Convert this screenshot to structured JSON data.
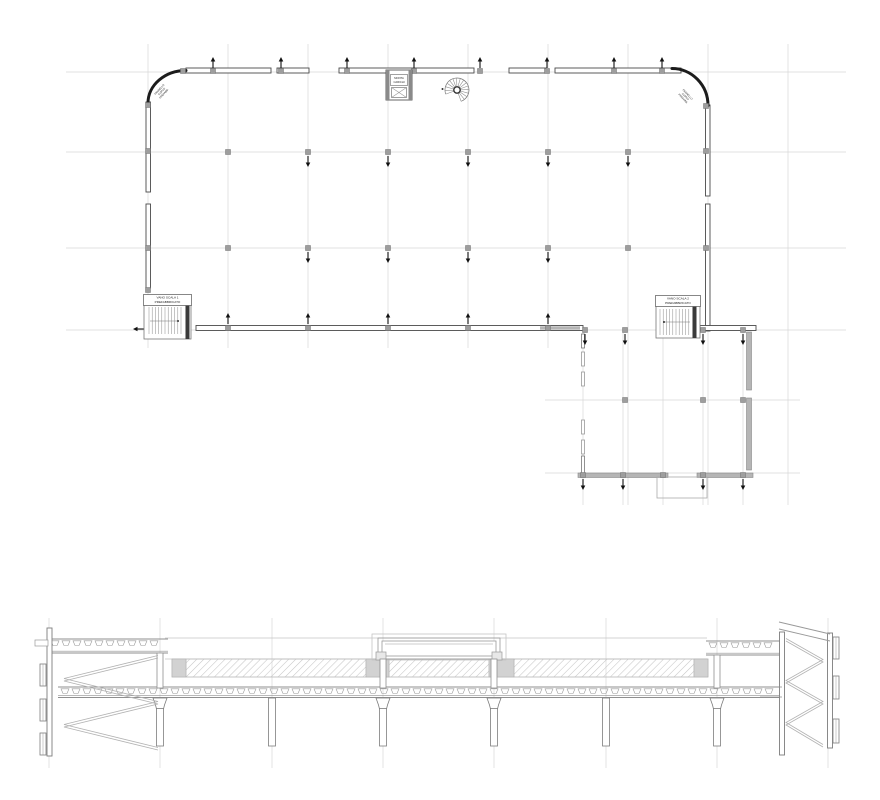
{
  "colors": {
    "grid": "#d7d7d7",
    "wall": "#4a4a4a",
    "dark": "#1c1c1c",
    "arrow": "#111111",
    "column_fill": "#9e9e9e",
    "column_stroke": "#707070",
    "gray_band": "#b5b5b5",
    "hatch_line": "#c6c6c6",
    "section_stroke": "#8f8f8f",
    "section_light": "#c4c4c4",
    "zigzag": "#b2b2b2",
    "tread": "#8a8a8a"
  },
  "plan": {
    "labels": {
      "stair1": [
        "VANO SCALA 1",
        "PREFABBRICATO"
      ],
      "stair2": [
        "VANO SCALA 2",
        "PREFABBRICATO"
      ],
      "elevator": [
        "MONTA",
        "CARICHI"
      ],
      "corner_left": [
        "PANNELLO",
        "CURVO",
        "PREFABB."
      ],
      "corner_right": [
        "PANNELLO",
        "CURVO",
        "PREFABB."
      ]
    },
    "grid": {
      "verticals_main": [
        148,
        228,
        308,
        388,
        468,
        548
      ],
      "verticals_long": [
        628,
        708,
        788
      ],
      "verticals_annex": [
        583,
        623,
        663,
        703,
        743
      ],
      "v_top": 44,
      "v_bottom_main": 348,
      "v_bottom_long": 505,
      "annex_v_top": 330,
      "annex_v_bottom": 505,
      "horizontals_main": [
        72,
        152,
        248,
        330
      ],
      "h_left": 66,
      "h_right": 846,
      "horizontals_annex": [
        400,
        473
      ],
      "annex_h_left": 545,
      "annex_h_right": 800
    },
    "walls": {
      "top": {
        "y": 68,
        "h": 5,
        "segments": [
          [
            186,
            271
          ],
          [
            277,
            309
          ],
          [
            339,
            474
          ],
          [
            509,
            546
          ],
          [
            555,
            681
          ]
        ]
      },
      "left": {
        "x": 146,
        "w": 4.5,
        "segments": [
          [
            102,
            192
          ],
          [
            204,
            288
          ]
        ]
      },
      "right": {
        "x": 705.5,
        "w": 4.5,
        "segments": [
          [
            105,
            196
          ],
          [
            204,
            331
          ]
        ]
      },
      "bottom": {
        "y": 325.5,
        "h": 5,
        "segments": [
          [
            196,
            583
          ],
          [
            700,
            756
          ]
        ]
      },
      "bottom_gray": [
        540,
        580
      ],
      "annex_bottom": {
        "y": 473,
        "h": 4.5,
        "segments": [
          [
            578,
            668
          ],
          [
            697,
            753
          ]
        ]
      },
      "annex_right": {
        "x": 746.5,
        "w": 5,
        "segments": [
          [
            332,
            390
          ],
          [
            398,
            470
          ]
        ]
      },
      "annex_left_dashed": {
        "x": 581.5,
        "w": 3,
        "solid": [
          [
            334,
            348
          ],
          [
            456,
            474
          ]
        ],
        "dashes": [
          [
            352,
            366
          ],
          [
            372,
            386
          ],
          [
            420,
            434
          ],
          [
            440,
            454
          ]
        ]
      },
      "canopy_rect": [
        657,
        477,
        50,
        21
      ]
    },
    "arcs": {
      "left": {
        "from": [
          186,
          70.5
        ],
        "to": [
          148,
          103
        ],
        "rx": 38,
        "ry": 32.5,
        "sweep": 0
      },
      "right": {
        "from": [
          672,
          68.5
        ],
        "to": [
          708,
          105.5
        ],
        "rx": 36,
        "ry": 37,
        "sweep": 1
      }
    },
    "columns": [
      [
        183,
        71
      ],
      [
        213,
        71
      ],
      [
        281,
        71
      ],
      [
        347,
        71
      ],
      [
        414,
        71
      ],
      [
        480,
        71
      ],
      [
        547,
        71
      ],
      [
        614,
        71
      ],
      [
        662,
        71
      ],
      [
        706,
        106
      ],
      [
        706,
        151
      ],
      [
        706,
        248
      ],
      [
        148,
        105
      ],
      [
        148,
        151
      ],
      [
        148,
        248
      ],
      [
        148,
        290
      ],
      [
        228,
        152
      ],
      [
        308,
        152
      ],
      [
        388,
        152
      ],
      [
        468,
        152
      ],
      [
        548,
        152
      ],
      [
        628,
        152
      ],
      [
        228,
        248
      ],
      [
        308,
        248
      ],
      [
        388,
        248
      ],
      [
        468,
        248
      ],
      [
        548,
        248
      ],
      [
        628,
        248
      ],
      [
        228,
        328
      ],
      [
        308,
        328
      ],
      [
        388,
        328
      ],
      [
        468,
        328
      ],
      [
        548,
        328
      ],
      [
        585,
        330
      ],
      [
        625,
        330
      ],
      [
        703,
        330
      ],
      [
        743,
        330
      ],
      [
        625,
        400
      ],
      [
        703,
        400
      ],
      [
        743,
        400
      ],
      [
        583,
        475
      ],
      [
        623,
        475
      ],
      [
        663,
        475
      ],
      [
        703,
        475
      ],
      [
        743,
        475
      ]
    ],
    "arrows": {
      "up": [
        {
          "xs": [
            213,
            281,
            347,
            414,
            480,
            547,
            614,
            662
          ],
          "tip": 57
        },
        {
          "xs": [
            228,
            308,
            388,
            468,
            548
          ],
          "tip": 313
        }
      ],
      "down": [
        {
          "xs": [
            308,
            388,
            468,
            548,
            628
          ],
          "tip": 167
        },
        {
          "xs": [
            308,
            388,
            468,
            548
          ],
          "tip": 263
        },
        {
          "xs": [
            585,
            625,
            703,
            743
          ],
          "tip": 345
        },
        {
          "xs": [
            583,
            623,
            703,
            743
          ],
          "tip": 490
        }
      ],
      "left": [
        {
          "x": 133,
          "y": 329
        }
      ]
    },
    "stair1": {
      "box": [
        144,
        303,
        47,
        36
      ],
      "label_box": [
        143.5,
        294.5,
        48,
        11
      ],
      "treads": {
        "x1": 149,
        "x2": 184,
        "step": 3.2,
        "y1": 307,
        "y2": 334
      },
      "walkline": {
        "y": 321,
        "x1": 150,
        "x2": 179
      },
      "dot": [
        178,
        321
      ],
      "bar": [
        185.5,
        303,
        4,
        36
      ]
    },
    "stair2": {
      "box": [
        656,
        305,
        44,
        33
      ],
      "label_box": [
        655.5,
        295.5,
        45,
        11
      ],
      "treads": {
        "x1": 660,
        "x2": 692,
        "step": 3.2,
        "y1": 309,
        "y2": 335
      },
      "walkline": {
        "y": 322,
        "x1": 663,
        "x2": 690
      },
      "dot": [
        664,
        322
      ],
      "bar": [
        692.5,
        305,
        4,
        33
      ]
    },
    "elevator": {
      "outer": [
        386,
        70,
        26,
        30
      ],
      "wall_w": 3.5,
      "label_box": [
        390.5,
        74.5,
        17,
        11
      ],
      "hatch_box": [
        391.5,
        87.5,
        15,
        10
      ]
    },
    "spiral": {
      "cx": 457,
      "cy": 90,
      "r_outer": 12,
      "r_inner": 3.2,
      "start_deg": -200,
      "end_deg": 70,
      "step_deg": 18
    },
    "corner_label_left": {
      "x": 160,
      "y": 90,
      "rot": -47,
      "fs": 2.6
    },
    "corner_label_right": {
      "x": 687,
      "y": 95,
      "rot": 47,
      "fs": 2.6
    }
  },
  "section": {
    "grid": {
      "xs": [
        49,
        160,
        272,
        383,
        494,
        606,
        717,
        828
      ],
      "y1": 618,
      "y2": 768
    },
    "rooflines": [
      {
        "y": 638,
        "x1": 165,
        "x2": 707
      },
      {
        "y": 659,
        "x1": 165,
        "x2": 707
      }
    ],
    "hatch_band": {
      "y1": 659,
      "y2": 677,
      "segments": [
        [
          186,
          366
        ],
        [
          389,
          489
        ],
        [
          514,
          694
        ]
      ],
      "gray_blocks": [
        [
          172,
          186
        ],
        [
          366,
          389
        ],
        [
          489,
          514
        ],
        [
          694,
          708
        ]
      ]
    },
    "rib_bands": [
      {
        "x1": 48,
        "x2": 168,
        "y1": 639,
        "y2": 653
      },
      {
        "x1": 706,
        "x2": 782,
        "y1": 641,
        "y2": 655
      },
      {
        "x1": 58,
        "x2": 782,
        "y1": 687,
        "y2": 697.5
      }
    ],
    "skylight": {
      "outer": [
        372,
        634,
        134,
        26
      ],
      "mid": [
        378,
        638,
        122,
        21
      ],
      "inner": [
        382,
        641,
        114,
        15
      ],
      "feet": [
        [
          376,
          652,
          10,
          8
        ],
        [
          492,
          652,
          10,
          8
        ]
      ]
    },
    "upper_columns": [
      [
        157,
        653,
        6,
        35
      ],
      [
        714,
        655,
        6,
        33
      ],
      [
        380,
        659,
        6,
        29
      ],
      [
        491,
        659,
        6,
        29
      ]
    ],
    "columns": {
      "xs": [
        160,
        272,
        383,
        494,
        606,
        717
      ],
      "haunched": [
        160,
        383,
        494,
        717
      ],
      "top": 698,
      "bottom": 746,
      "shaft_w": 7,
      "cap_w": 14,
      "cap_h": 11
    },
    "left_tower": {
      "wall": [
        47,
        628,
        5,
        128
      ],
      "canopy": [
        35,
        640,
        13,
        6
      ],
      "louvers": [
        [
          40,
          664,
          6,
          22
        ],
        [
          40,
          699,
          6,
          22
        ],
        [
          40,
          733,
          6,
          22
        ]
      ],
      "zigzag": [
        [
          158,
          658
        ],
        [
          64,
          681
        ],
        [
          158,
          704
        ],
        [
          64,
          727
        ],
        [
          158,
          750
        ]
      ]
    },
    "right_tower": {
      "inner_wall": [
        779.5,
        632,
        5,
        123
      ],
      "outer_wall": [
        827.5,
        633,
        5,
        115
      ],
      "slants": [
        [
          [
            779,
            622
          ],
          [
            830,
            634
          ]
        ],
        [
          [
            779,
            629
          ],
          [
            830,
            641
          ]
        ]
      ],
      "louvers": [
        [
          833,
          637,
          6,
          22
        ],
        [
          833,
          676,
          6,
          23
        ],
        [
          833,
          719,
          6,
          24
        ]
      ],
      "zigzag": [
        [
          786,
          641
        ],
        [
          823,
          662
        ],
        [
          786,
          683
        ],
        [
          823,
          704
        ],
        [
          786,
          725
        ],
        [
          823,
          747
        ]
      ],
      "deck_stub": [
        760,
        687,
        22,
        10
      ]
    }
  }
}
